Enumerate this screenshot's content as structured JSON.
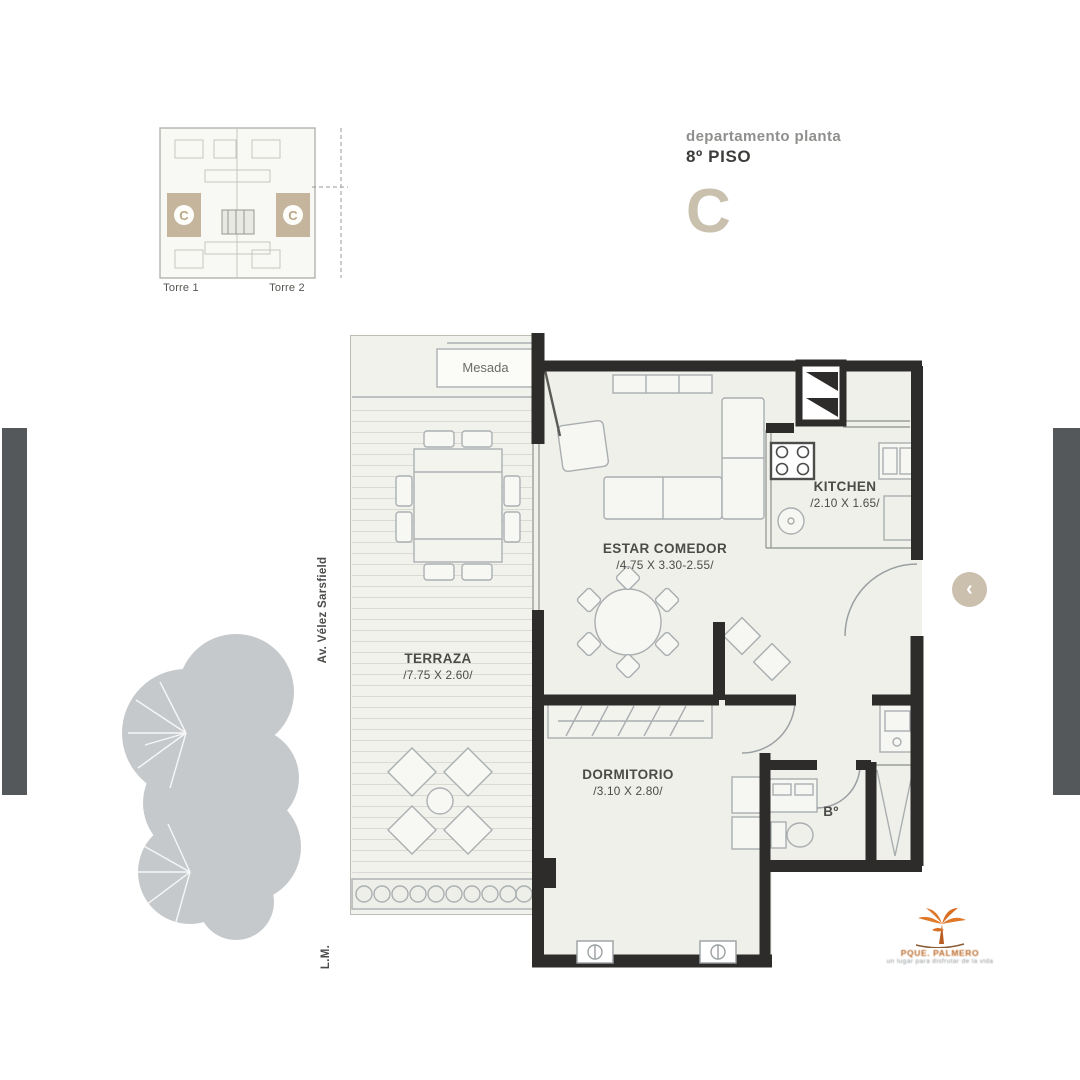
{
  "header": {
    "kicker": "departamento planta",
    "floor": "8º PISO",
    "unit": "C"
  },
  "key_plan": {
    "towers": [
      {
        "label": "Torre 1",
        "unit": "C"
      },
      {
        "label": "Torre 2",
        "unit": "C"
      }
    ]
  },
  "plan": {
    "rooms": [
      {
        "name": "TERRAZA",
        "dims": "/7.75 X 2.60/"
      },
      {
        "name": "ESTAR COMEDOR",
        "dims": "/4.75 X 3.30-2.55/"
      },
      {
        "name": "KITCHEN",
        "dims": "/2.10 X 1.65/"
      },
      {
        "name": "DORMITORIO",
        "dims": "/3.10 X 2.80/"
      },
      {
        "name": "Bº",
        "dims": ""
      }
    ],
    "mesada": "Mesada",
    "street": "Av. Vélez Sarsfield",
    "property_line": "L.M."
  },
  "carousel": {
    "prev": "‹"
  },
  "logo": {
    "brand": "PQUE. PALMERO",
    "tagline": "un lugar para disfrutar de la vida"
  },
  "colors": {
    "accent_tan": "#c9c0ae",
    "wall_black": "#2d2c2a",
    "logo_orange": "#e0782a",
    "tree_gray": "#c6c9cb",
    "edge_bar_gray": "#54585b",
    "plan_fill": "#f0f0ea"
  }
}
